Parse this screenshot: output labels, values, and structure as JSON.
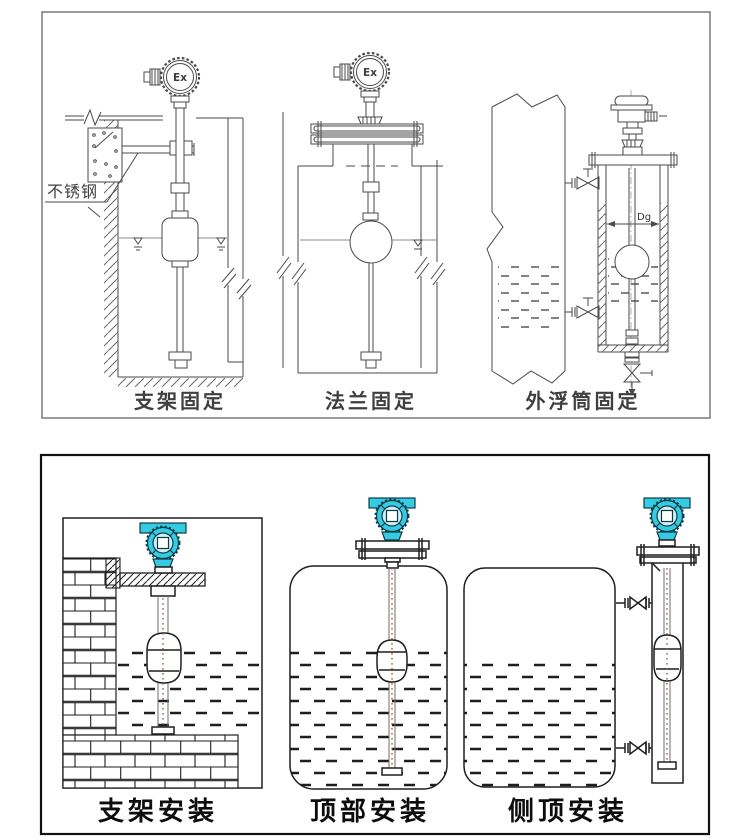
{
  "colors": {
    "teal": "#35cbe3",
    "teal_light": "#cfeff7",
    "red_dash": "#a0523d",
    "top_line": "#4a4a4a",
    "bottom_line": "#1e1e1e"
  },
  "top_panel": {
    "captions": {
      "bracket": "支架固定",
      "flange": "法兰固定",
      "chamber": "外浮筒固定"
    },
    "labels": {
      "stainless": "不锈钢",
      "ex": "Ex",
      "dg": "Dg"
    }
  },
  "bottom_panel": {
    "captions": {
      "bracket": "支架安装",
      "top": "顶部安装",
      "side": "侧顶安装"
    }
  }
}
